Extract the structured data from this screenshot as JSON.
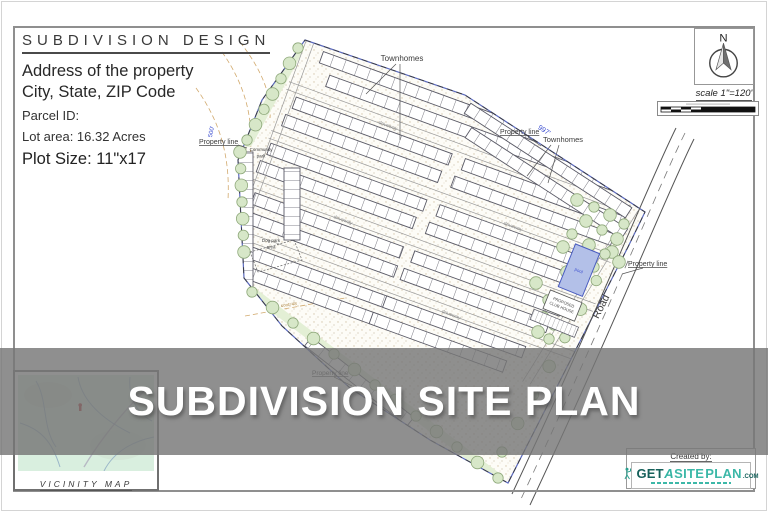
{
  "title_block": {
    "title": "SUBDIVISION DESIGN",
    "address_line": "Address of the property",
    "city_line": "City, State, ZIP Code",
    "parcel_id": "Parcel ID:",
    "lot_area": "Lot area: 16.32 Acres",
    "plot_size": "Plot Size: 11\"x17"
  },
  "north_block": {
    "north_label": "N",
    "scale_text": "scale 1\"=120'"
  },
  "plan": {
    "townhomes_label": "Townhomes",
    "property_line_label": "Property line",
    "community_park_line1": "Community",
    "community_park_line2": "park",
    "dog_park_line1": "Dog park",
    "dog_park_line2": "area",
    "pool_label": "pool",
    "club_house_line1": "PROPOSED",
    "club_house_line2": "CLUB HOUSE",
    "road_label": "Road",
    "driveway_label": "driveway",
    "dim_top_edge": "997'",
    "dim_left_edge": "500'",
    "contour_label": "cont=48"
  },
  "banner": {
    "title": "SUBDIVISION SITE PLAN"
  },
  "vicinity_map": {
    "label": "VICINITY MAP"
  },
  "credit": {
    "created_by": "Created by:",
    "logo_get": "GET",
    "logo_a": "A",
    "logo_site": "SITE",
    "logo_plan": "PLAN",
    "logo_com": ".COM"
  }
}
